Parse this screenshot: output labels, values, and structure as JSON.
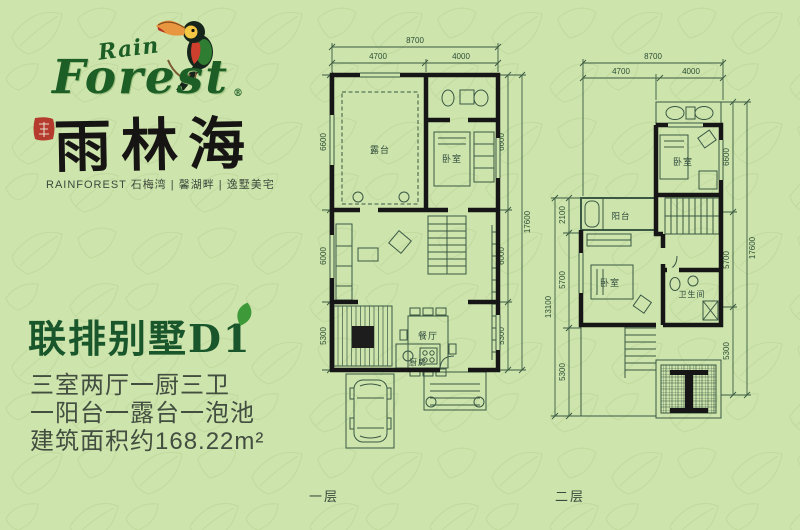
{
  "page": {
    "background": "#cee4ad",
    "pattern_color": "#b7d393"
  },
  "logo": {
    "rain": "Rain",
    "forest": "Forest",
    "reg": "®",
    "brand": "雨林海",
    "subtitle": "RAINFOREST  石梅湾 | 馨湖畔 | 逸墅美宅"
  },
  "listing": {
    "title": "联排别墅D1",
    "line1": "三室两厅一厨三卫",
    "line2": "一阳台一露台一泡池",
    "line3": "建筑面积约168.22m²"
  },
  "floor1": {
    "caption": "一层",
    "rooms": {
      "terrace": "露台",
      "bedroom": "卧室",
      "dining": "餐厅",
      "kitchen": "厨房"
    },
    "dims": {
      "top_total": "8700",
      "top_a": "4700",
      "top_b": "4000",
      "left_a": "6600",
      "left_b": "6000",
      "left_c": "5300",
      "right_a": "6600",
      "right_b": "6000",
      "right_c": "5300",
      "right_total": "17600"
    }
  },
  "floor2": {
    "caption": "二层",
    "rooms": {
      "bedroom_top": "卧室",
      "bedroom": "卧室",
      "bathroom": "卫生间",
      "balcony": "阳台"
    },
    "dims": {
      "top_total": "8700",
      "top_a": "4700",
      "top_b": "4000",
      "left_total": "13100",
      "left_a": "2100",
      "left_b": "5700",
      "left_c": "5300",
      "right_a": "6600",
      "right_b": "5700",
      "right_c": "5300",
      "right_total": "17600"
    }
  }
}
